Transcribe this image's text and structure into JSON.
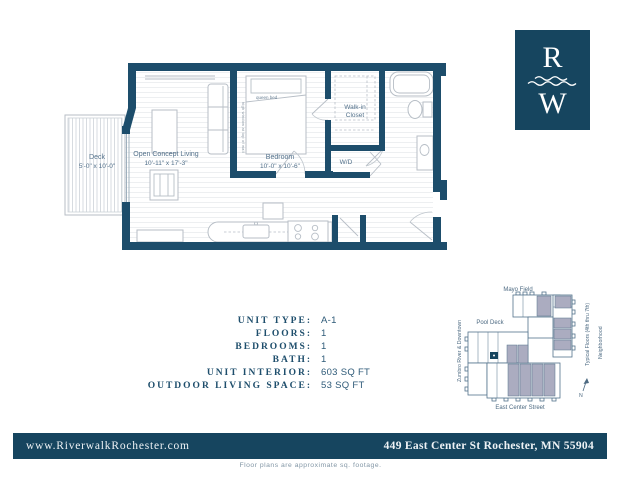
{
  "colors": {
    "navy": "#16455f",
    "wall_navy": "#1d4d6b",
    "map_unit_shade": "#abacc0",
    "furniture_gray": "#b7bec6"
  },
  "logo": {
    "letter_top": "R",
    "letter_bottom": "W"
  },
  "floor_plan": {
    "deck_name": "Deck",
    "deck_dims": "5'-0\" x 10'-0\"",
    "living_name": "Open Concept Living",
    "living_dims": "10'-11\" x 17'-3\"",
    "bedroom_name": "Bedroom",
    "bedroom_dims": "10'-0\" x 10'-6\"",
    "bed_label": "queen bed",
    "closet_line1": "Walk-in",
    "closet_line2": "Closet",
    "wd_label": "W/D",
    "window_note": "high window at top of wall"
  },
  "details": {
    "rows": [
      {
        "label": "UNIT TYPE:",
        "value": "A-1"
      },
      {
        "label": "FLOORS:",
        "value": "1"
      },
      {
        "label": "BEDROOMS:",
        "value": "1"
      },
      {
        "label": "BATH:",
        "value": "1"
      },
      {
        "label": "UNIT INTERIOR:",
        "value": "603 SQ FT"
      },
      {
        "label": "OUTDOOR LIVING SPACE:",
        "value": "53 SQ FT"
      }
    ]
  },
  "site_map": {
    "mayo_field": "Mayo Field",
    "pool_deck": "Pool Deck",
    "zumbro": "Zumbro River & Downtown",
    "street": "East Center Street",
    "typical_floors": "Typical Floors (4th thru 7th)",
    "neighborhood": "Neighborhood",
    "compass": "N"
  },
  "footer": {
    "website": "www.RiverwalkRochester.com",
    "address": "449 East Center St Rochester, MN 55904",
    "disclaimer": "Floor plans are approximate sq. footage."
  }
}
